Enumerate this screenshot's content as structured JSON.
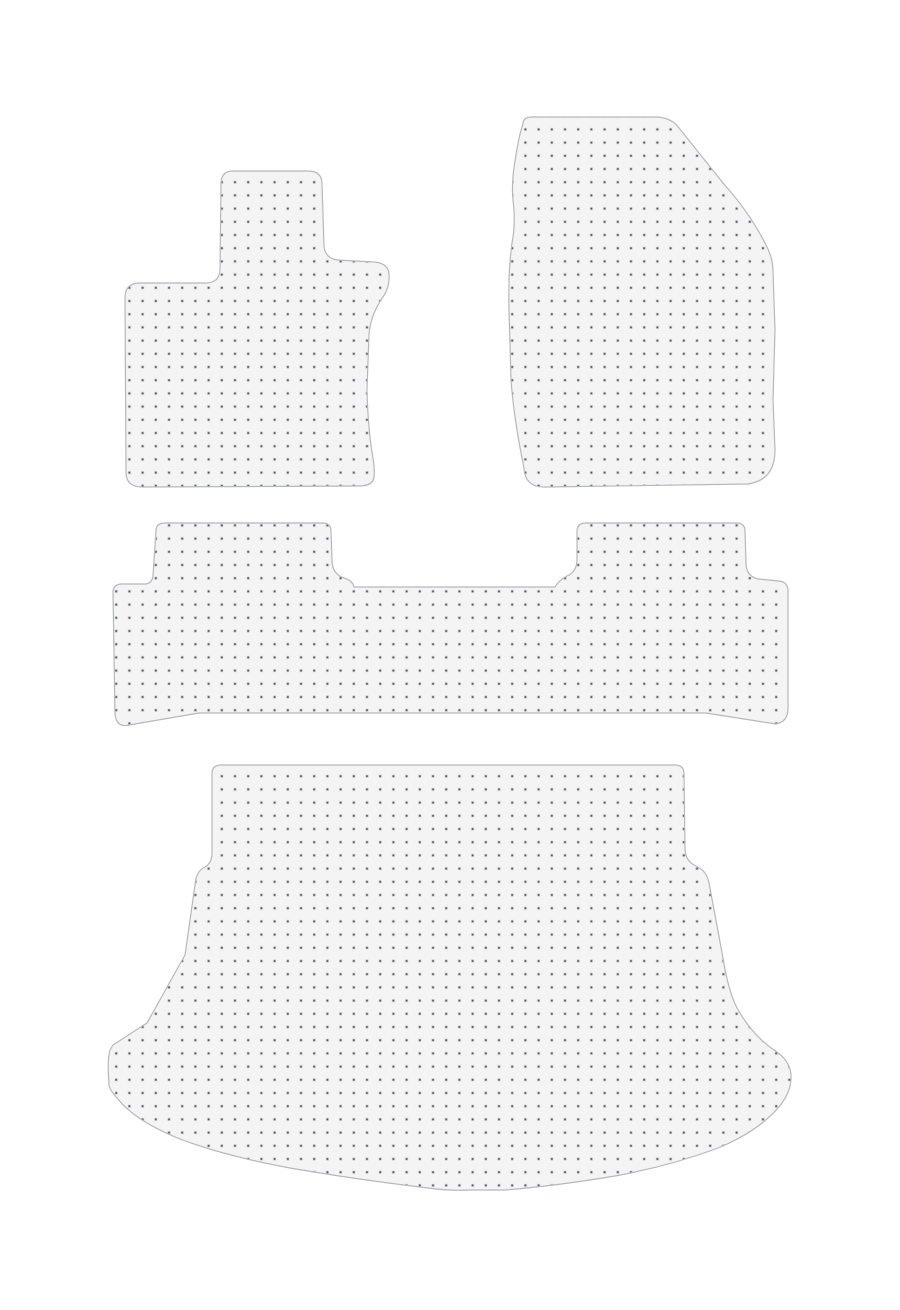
{
  "scene": {
    "description": "Product image of a four-piece clear vinyl car floor mat set with gripper-dot pattern on a plain white background",
    "background": "#ffffff",
    "width": 900,
    "height": 1310
  },
  "product": {
    "piece_count": 4,
    "colors": {
      "mat_fill": "#f4f4f5",
      "mat_border": "#b5b8bb",
      "dot_color": "#55565a",
      "dot_halo": "#dfe0e2"
    },
    "dot_pattern": {
      "spacing_px": 13.2,
      "dot_size_px": 1.9,
      "halo_size_px": 3.4
    },
    "mats": [
      {
        "id": "front-driver-mat",
        "label": "front driver floor mat",
        "path": "M 221,184 Q 221,171 233,171 L 308,171 Q 322,171 322,184 L 324,246 Q 325,258 337,260 L 374,262 Q 388,263 389,274 Q 390,287 383,297 Q 371,314 369,334 L 367,390 Q 368,430 373,458 Q 375,472 374,477 Q 373,486 359,486 L 142,487 Q 126,487 126,472 L 125,298 Q 125,283 140,283 L 206,283 Q 219,283 220,270 Z"
      },
      {
        "id": "front-passenger-mat",
        "label": "front passenger floor mat",
        "path": "M 523,124 Q 523,117 532,117 L 655,117 Q 671,117 679,128 L 723,183 Q 750,213 766,245 Q 773,258 773,272 L 775,330 L 773,400 L 775,450 Q 775,480 748,484 L 546,487 Q 525,488 524,468 Q 514,420 511,380 L 509,310 Q 508,272 512,243 Q 516,223 513,200 Q 511,182 516,155 Q 519,135 523,124 Z"
      },
      {
        "id": "rear-bench-mat",
        "label": "rear bench floor mat",
        "path": "M 156,531 Q 156,523 165,523 L 322,523 Q 331,523 331,531 L 332,560 Q 332,574 344,578 Q 353,581 354,587 L 555,587 Q 559,580 567,576 Q 577,572 577,559 L 577,531 Q 577,523 586,523 L 736,523 Q 745,523 745,531 L 746,563 Q 746,576 758,579 L 779,581 Q 788,582 788,591 L 788,708 Q 788,722 776,724 L 706,713 L 199,713 L 129,725 Q 117,728 115,715 L 113,593 Q 113,584 122,584 L 146,584 Q 152,583 153,576 Z"
      },
      {
        "id": "boot-mat",
        "label": "boot / trunk mat",
        "path": "M 212,774 Q 212,765 221,765 L 675,765 Q 684,765 684,774 L 685,848 Q 685,861 696,866 Q 707,871 709,883 Q 716,920 723,958 Q 728,990 737,1008 Q 752,1035 774,1050 Q 790,1060 791,1075 Q 792,1092 778,1108 Q 757,1132 718,1148 Q 670,1166 615,1176 Q 555,1186 505,1190 L 470,1190 Q 450,1191 428,1188 Q 360,1180 290,1168 Q 225,1156 180,1139 Q 135,1121 117,1098 Q 108,1088 109,1083 Q 107,1060 110,1050 L 113,1045 L 147,1023 L 185,955 L 195,885 Q 196,871 205,867 Q 212,863 212,853 Z"
      }
    ]
  }
}
